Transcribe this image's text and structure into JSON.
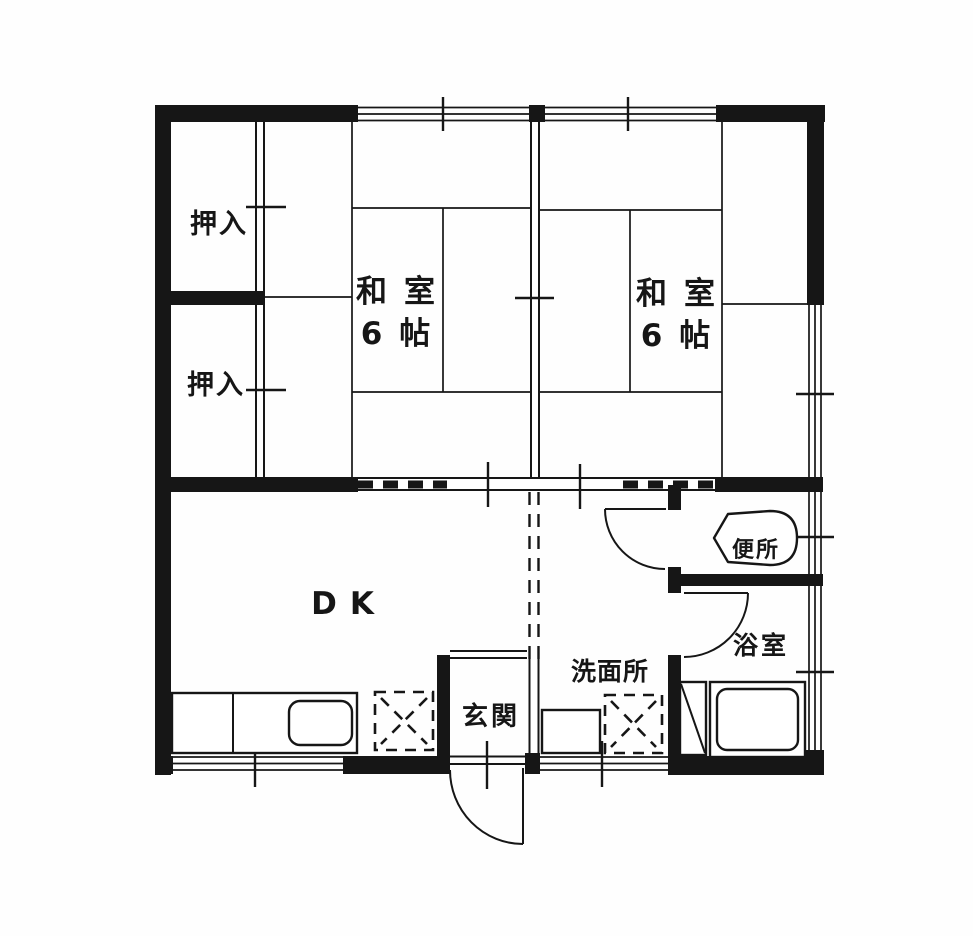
{
  "document_type": "floor-plan",
  "colors": {
    "ink": "#161616",
    "background": "#fefefe"
  },
  "rooms": {
    "closet_upper": {
      "label": "押入"
    },
    "closet_lower": {
      "label": "押入"
    },
    "washitsu_left": {
      "label": "和室",
      "size": "6帖"
    },
    "washitsu_right": {
      "label": "和室",
      "size": "6帖"
    },
    "dk": {
      "label": "DK"
    },
    "genkan": {
      "label": "玄関"
    },
    "washroom": {
      "label": "洗面所"
    },
    "bathroom": {
      "label": "浴室"
    },
    "toilet": {
      "label": "便所"
    }
  },
  "fixtures": {
    "kitchen_sink": "kitchen-counter-with-sink",
    "kitchen_appliance_space": "dashed-appliance-space",
    "washbasin": "washbasin",
    "laundry_space": "dashed-appliance-space",
    "toilet_bowl": "toilet-bowl",
    "bathtub": "bathtub",
    "bath_heater": "bath-heater-unit"
  }
}
